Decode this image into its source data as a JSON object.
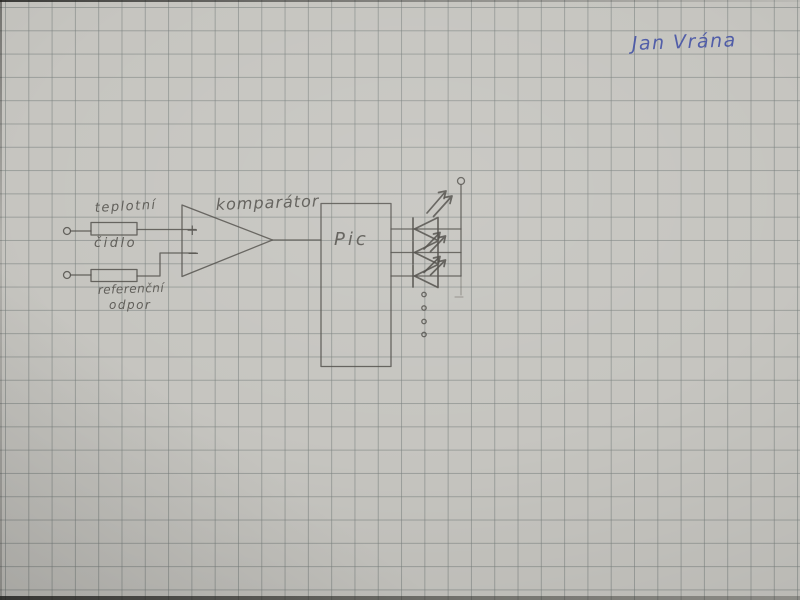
{
  "paper": {
    "base_color": "#c6c5c0",
    "grid_color": "#787f7d",
    "pencil_color": "#514f4a",
    "ink_color": "#4452a6"
  },
  "signature": "Jan Vrána",
  "diagram": {
    "temperature_sensor": {
      "line1": "teplotní",
      "line2": "čidlo"
    },
    "reference_resistor": {
      "line1": "referenční",
      "line2": "odpor"
    },
    "comparator": {
      "label": "komparátor",
      "plus_input": "+",
      "minus_input": "−"
    },
    "mcu": {
      "label": "Pic"
    },
    "leds": {
      "drawn_count": 3,
      "more_indicator_dots": 4
    }
  }
}
